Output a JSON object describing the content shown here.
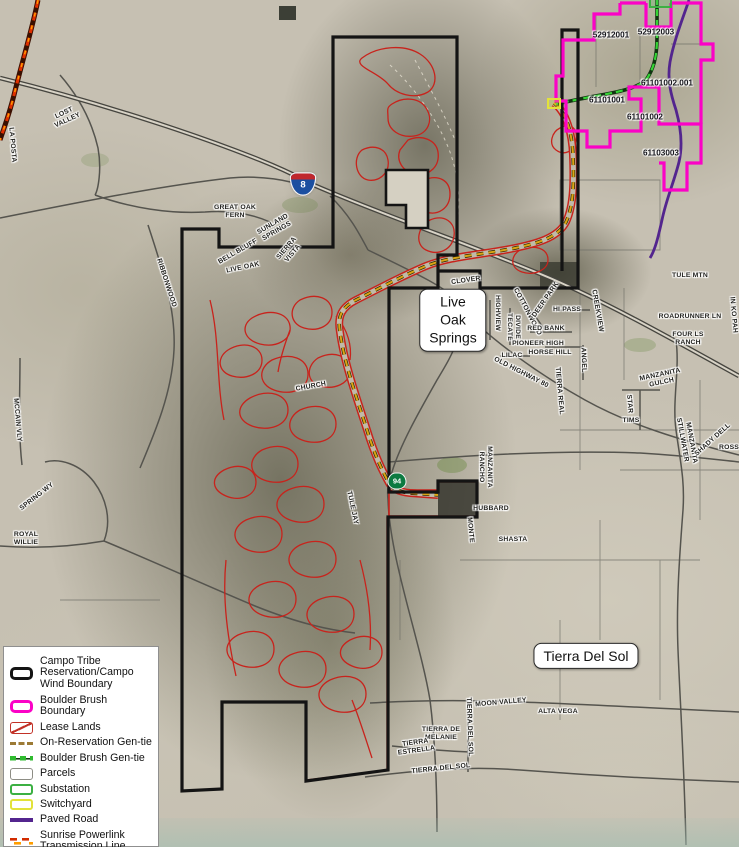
{
  "map": {
    "place_boxes": [
      {
        "text": "Live\nOak\nSprings",
        "x": 453,
        "y": 320
      },
      {
        "text": "Tierra Del Sol",
        "x": 586,
        "y": 656
      }
    ],
    "shields": [
      {
        "type": "interstate",
        "number": "8"
      },
      {
        "type": "state",
        "number": "94"
      }
    ],
    "parcel_labels": [
      {
        "text": "52912001",
        "x": 611,
        "y": 35
      },
      {
        "text": "52912003",
        "x": 656,
        "y": 32
      },
      {
        "text": "61101002.001",
        "x": 667,
        "y": 83
      },
      {
        "text": "61101001",
        "x": 607,
        "y": 100
      },
      {
        "text": "61101002",
        "x": 645,
        "y": 117
      },
      {
        "text": "61103003",
        "x": 661,
        "y": 153
      }
    ],
    "street_labels": [
      {
        "text": "CLOVER",
        "x": 466,
        "y": 281,
        "rot": -8
      },
      {
        "text": "HIGHVIEW",
        "x": 497,
        "y": 313,
        "rot": 90
      },
      {
        "text": "TECATE",
        "x": 509,
        "y": 327,
        "rot": 90
      },
      {
        "text": "DIVIDE",
        "x": 517,
        "y": 327,
        "rot": 90
      },
      {
        "text": "COTTONWOOD",
        "x": 527,
        "y": 312,
        "rot": 62
      },
      {
        "text": "DEER PARK",
        "x": 546,
        "y": 300,
        "rot": -55
      },
      {
        "text": "HI PASS",
        "x": 567,
        "y": 310,
        "rot": 0
      },
      {
        "text": "RED BANK",
        "x": 546,
        "y": 329,
        "rot": 0
      },
      {
        "text": "PIONEER HIGH",
        "x": 538,
        "y": 344,
        "rot": 0
      },
      {
        "text": "HORSE HILL",
        "x": 550,
        "y": 353,
        "rot": 0
      },
      {
        "text": "LILAC",
        "x": 512,
        "y": 356,
        "rot": 0
      },
      {
        "text": "OLD HIGHWAY 80",
        "x": 521,
        "y": 373,
        "rot": 27
      },
      {
        "text": "TIERRA REAL",
        "x": 559,
        "y": 391,
        "rot": 85
      },
      {
        "text": "ANGEL",
        "x": 583,
        "y": 360,
        "rot": 88
      },
      {
        "text": "CREEKVIEW",
        "x": 597,
        "y": 311,
        "rot": 80
      },
      {
        "text": "TULE MTN",
        "x": 690,
        "y": 276,
        "rot": 0
      },
      {
        "text": "ROADRUNNER LN",
        "x": 690,
        "y": 317,
        "rot": 0
      },
      {
        "text": "FOUR LS\nRANCH",
        "x": 688,
        "y": 339,
        "rot": 0
      },
      {
        "text": "MANZANITA\nGULCH",
        "x": 661,
        "y": 379,
        "rot": -12
      },
      {
        "text": "STAR",
        "x": 629,
        "y": 404,
        "rot": 85
      },
      {
        "text": "TIMS",
        "x": 631,
        "y": 421,
        "rot": 0
      },
      {
        "text": "STILLWATER",
        "x": 682,
        "y": 440,
        "rot": 80
      },
      {
        "text": "MANZANITA",
        "x": 691,
        "y": 443,
        "rot": 80
      },
      {
        "text": "SHADY DELL",
        "x": 713,
        "y": 440,
        "rot": -42
      },
      {
        "text": "ROSS",
        "x": 729,
        "y": 448,
        "rot": 0
      },
      {
        "text": "RANCHO",
        "x": 481,
        "y": 467,
        "rot": 90
      },
      {
        "text": "MANZANITA",
        "x": 489,
        "y": 467,
        "rot": 90
      },
      {
        "text": "HUBBARD",
        "x": 491,
        "y": 509,
        "rot": 0
      },
      {
        "text": "TULE JAY",
        "x": 352,
        "y": 508,
        "rot": 78
      },
      {
        "text": "MONTE",
        "x": 470,
        "y": 530,
        "rot": 85
      },
      {
        "text": "SHASTA",
        "x": 513,
        "y": 540,
        "rot": 0
      },
      {
        "text": "CHURCH",
        "x": 311,
        "y": 387,
        "rot": -10
      },
      {
        "text": "RIBBONWOOD",
        "x": 166,
        "y": 283,
        "rot": 72
      },
      {
        "text": "MOON VALLEY",
        "x": 501,
        "y": 703,
        "rot": -5
      },
      {
        "text": "ALTA VEGA",
        "x": 558,
        "y": 712,
        "rot": 0
      },
      {
        "text": "TIERRA DE\nMELANIE",
        "x": 441,
        "y": 734,
        "rot": 0
      },
      {
        "text": "TIERRA DEL SOL",
        "x": 469,
        "y": 727,
        "rot": 88
      },
      {
        "text": "TIERRA\nESTRELLA",
        "x": 416,
        "y": 747,
        "rot": -8
      },
      {
        "text": "TIERRA DEL SOL",
        "x": 441,
        "y": 769,
        "rot": -6
      },
      {
        "text": "LOST\nVALLEY",
        "x": 66,
        "y": 117,
        "rot": -25
      },
      {
        "text": "LA POSTA",
        "x": 12,
        "y": 145,
        "rot": 85
      },
      {
        "text": "MCCAIN VLY",
        "x": 17,
        "y": 420,
        "rot": 85
      },
      {
        "text": "SPRING WY",
        "x": 37,
        "y": 497,
        "rot": -38
      },
      {
        "text": "ROYAL\nWILLIE",
        "x": 26,
        "y": 539,
        "rot": 0
      },
      {
        "text": "GREAT OAK\nFERN",
        "x": 235,
        "y": 212,
        "rot": 0
      },
      {
        "text": "SUNLAND\nSPRINGS",
        "x": 275,
        "y": 228,
        "rot": -30
      },
      {
        "text": "BELL BLUFF",
        "x": 238,
        "y": 252,
        "rot": -30
      },
      {
        "text": "SIERRA\nVISTA",
        "x": 290,
        "y": 251,
        "rot": -50
      },
      {
        "text": "LIVE OAK",
        "x": 243,
        "y": 268,
        "rot": -12
      },
      {
        "text": "IN KO PAH",
        "x": 733,
        "y": 315,
        "rot": 85
      }
    ]
  },
  "legend": {
    "items": [
      {
        "label": "Campo Tribe Reservation/Campo Wind Boundary",
        "type": "campo"
      },
      {
        "label": "Boulder Brush Boundary",
        "type": "boulder"
      },
      {
        "label": "Lease Lands",
        "type": "lease"
      },
      {
        "label": "On-Reservation Gen-tie",
        "type": "onres"
      },
      {
        "label": "Boulder Brush Gen-tie",
        "type": "bbgen"
      },
      {
        "label": "Parcels",
        "type": "parcels"
      },
      {
        "label": "Substation",
        "type": "substation"
      },
      {
        "label": "Switchyard",
        "type": "switchyard"
      },
      {
        "label": "Paved Road",
        "type": "paved"
      },
      {
        "label": "Sunrise Powerlink Transmission Line",
        "type": "sunrise"
      }
    ]
  },
  "colors": {
    "campo_boundary": "#141414",
    "boulder_brush_boundary": "#fb02c6",
    "lease_lands": "#c8231c",
    "on_reservation_gen_tie": "#d9a614",
    "boulder_brush_gen_tie": "#35d435",
    "parcels": "#8d8d85",
    "substation": "#3cb043",
    "switchyard": "#e2e23a",
    "paved_road": "#53258e",
    "sunrise_powerlink": "#d22b00"
  }
}
